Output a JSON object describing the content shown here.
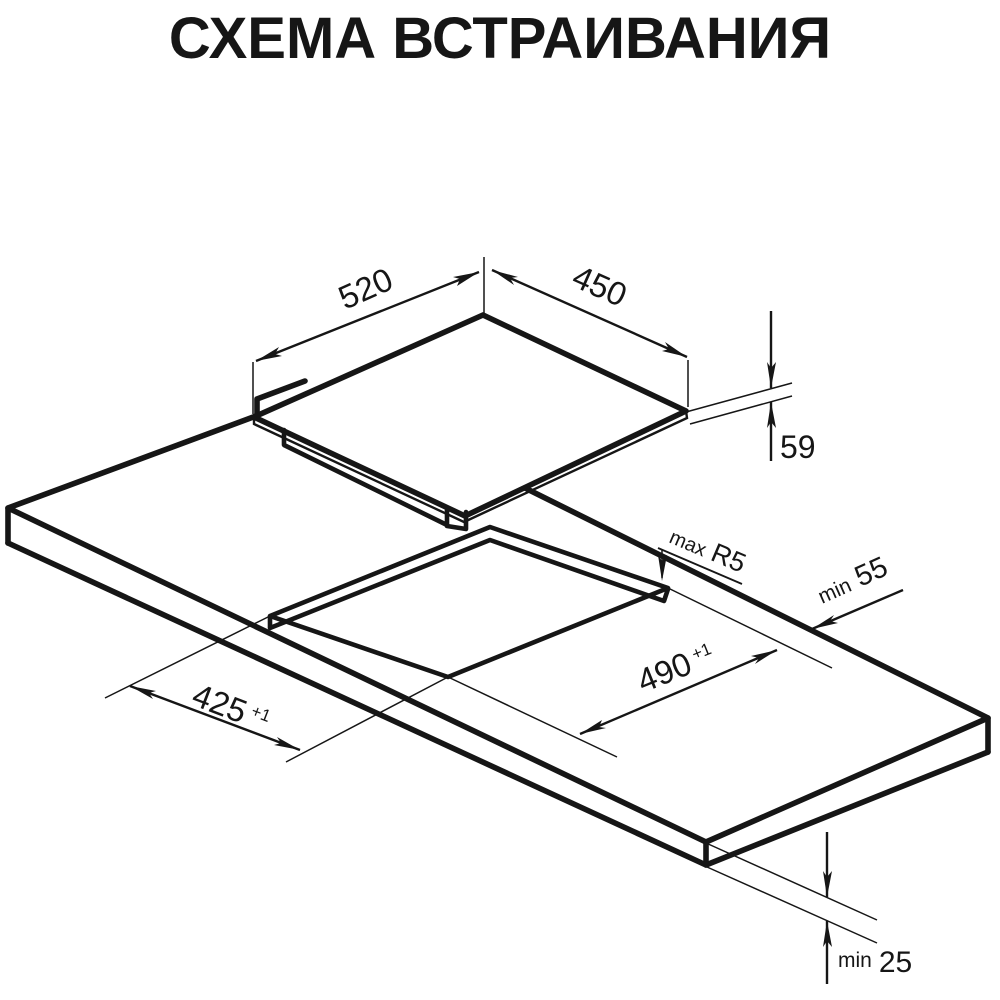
{
  "title": "СХЕМА ВСТРАИВАНИЯ",
  "colors": {
    "ink": "#161616",
    "background": "#ffffff"
  },
  "diagram": {
    "type": "isometric-installation-drawing",
    "subject": "built-in cooktop over countertop cutout",
    "dimensions": {
      "hob_width": {
        "value": "520"
      },
      "hob_depth": {
        "value": "450"
      },
      "hob_height": {
        "value": "59"
      },
      "cutout_length": {
        "value": "490",
        "tolerance": "+1"
      },
      "cutout_width": {
        "value": "425",
        "tolerance": "+1"
      },
      "corner_radius": {
        "prefix": "max",
        "value": "R5"
      },
      "rear_clearance": {
        "prefix": "min",
        "value": "55"
      },
      "counter_min_thickness": {
        "prefix": "min",
        "value": "25"
      }
    }
  }
}
